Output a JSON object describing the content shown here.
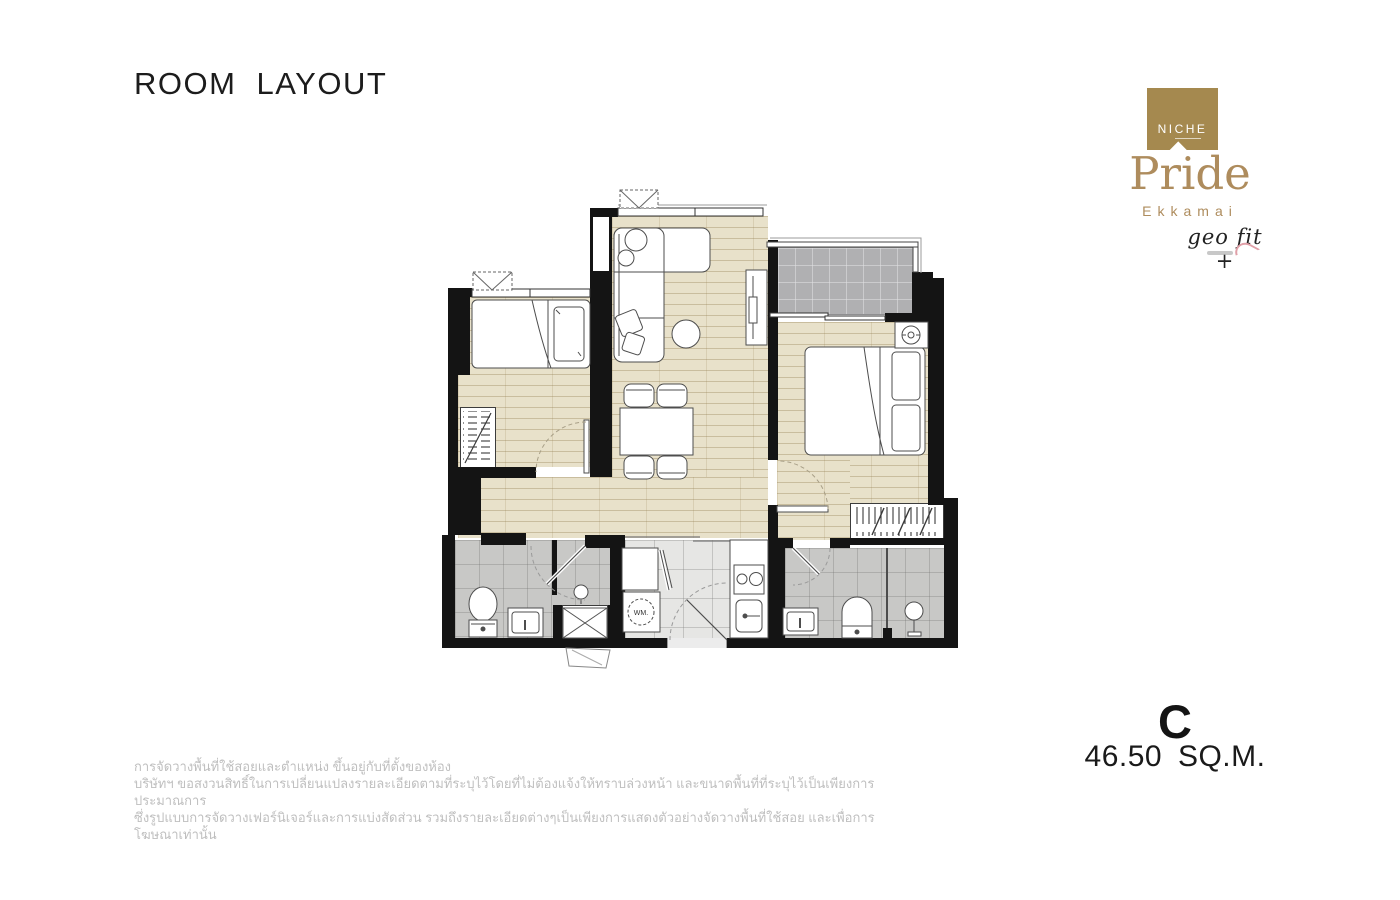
{
  "header": {
    "title": "ROOM LAYOUT"
  },
  "logo": {
    "brand": "NICHE",
    "project": "Pride",
    "location": "Ekkamai",
    "tagline": "geo fit +"
  },
  "unit": {
    "type": "C",
    "area": "46.50  SQ.M."
  },
  "plan": {
    "wm_label": "WM."
  },
  "disclaimer": {
    "lines": [
      "การจัดวางพื้นที่ใช้สอยและตำแหน่ง ขึ้นอยู่กับที่ตั้งของห้อง",
      "บริษัทฯ ขอสงวนสิทธิ์ในการเปลี่ยนแปลงรายละเอียดตามที่ระบุไว้โดยที่ไม่ต้องแจ้งให้ทราบล่วงหน้า และขนาดพื้นที่ที่ระบุไว้เป็นเพียงการประมาณการ",
      "ซึ่งรูปแบบการจัดวางเฟอร์นิเจอร์และการแบ่งสัดส่วน รวมถึงรายละเอียดต่างๆเป็นเพียงการแสดงตัวอย่างจัดวางพื้นที่ใช้สอย และเพื่อการโฆษณาเท่านั้น"
    ]
  },
  "colors": {
    "brand_gold": "#a5894f",
    "brand_text_gold": "#ae8c5d",
    "wall_black": "#141414",
    "wood_floor": "#e8e1ca",
    "bath_tile": "#c8c8c6",
    "balcony_tile": "#b0b0b2",
    "kitchen_tile": "#e6e6e4",
    "disclaimer_gray": "#bfbfbf"
  }
}
